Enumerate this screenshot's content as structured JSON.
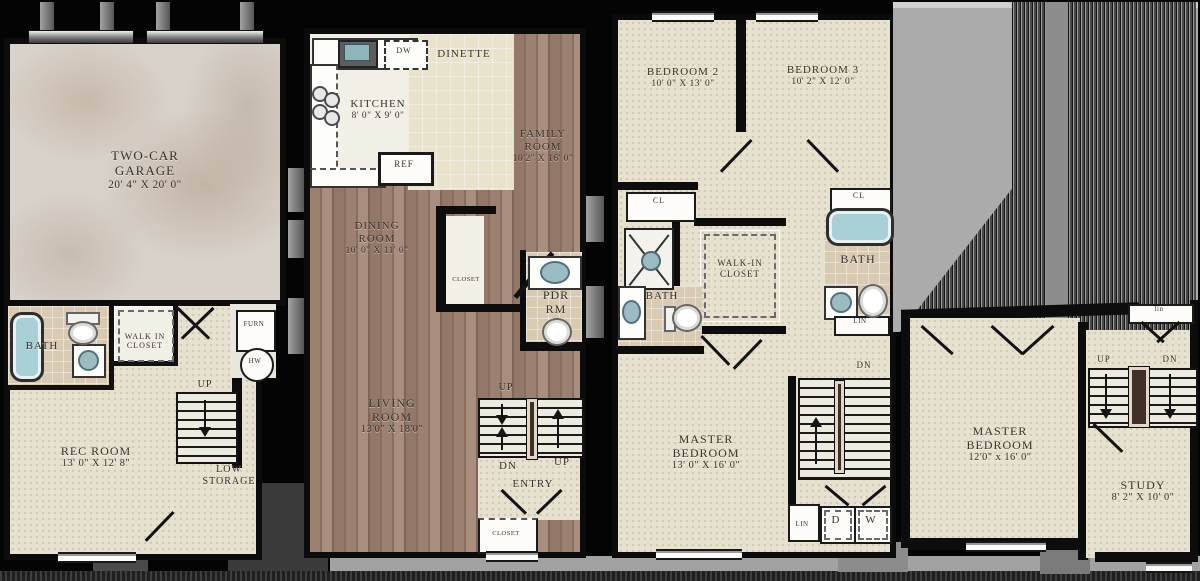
{
  "basement": {
    "garage": {
      "line1": "TWO-CAR",
      "line2": "GARAGE",
      "dims": "20' 4\" X 20' 0\""
    },
    "bath": {
      "label": "BATH"
    },
    "walk_in_closet": {
      "line1": "WALK IN",
      "line2": "CLOSET"
    },
    "rec_room": {
      "line1": "REC ROOM",
      "dims": "13' 0\" X 12' 8\""
    },
    "stairs": {
      "up": "UP"
    },
    "low_storage": {
      "line1": "LOW",
      "line2": "STORAGE"
    },
    "furnace": "FURN",
    "water_heater": "HW"
  },
  "main": {
    "kitchen": {
      "name": "KITCHEN",
      "dims": "8' 0\" X 9' 0\""
    },
    "dishwasher": "DW",
    "refrigerator": "REF",
    "dinette": "DINETTE",
    "family_room": {
      "line1": "FAMILY",
      "line2": "ROOM",
      "dims": "10'2\" X 16' 0\""
    },
    "dining_room": {
      "line1": "DINING",
      "line2": "ROOM",
      "dims": "10' 0\" X 11' 0\""
    },
    "closet": "CLOSET",
    "powder_room": {
      "line1": "PDR",
      "line2": "RM"
    },
    "living_room": {
      "line1": "LIVING",
      "line2": "ROOM",
      "dims": "13'0\" X 18'0\""
    },
    "stairs": {
      "up_top": "UP",
      "down": "DN",
      "up_right": "UP"
    },
    "entry": "ENTRY",
    "entry_closet": "CLOSET"
  },
  "second": {
    "bedroom2": {
      "name": "BEDROOM 2",
      "dims": "10' 0\" X 13' 0\""
    },
    "bedroom3": {
      "name": "BEDROOM 3",
      "dims": "10' 2\" X 12' 0\""
    },
    "closet_left": "CL",
    "closet_right": "CL",
    "walk_in_closet": {
      "line1": "WALK-IN",
      "line2": "CLOSET"
    },
    "bath_left": "BATH",
    "bath_right": "BATH",
    "linen_right": "LIN",
    "stairs": {
      "down": "DN"
    },
    "master_bedroom": {
      "line1": "MASTER",
      "line2": "BEDROOM",
      "dims": "13' 0\" X 16' 0\""
    },
    "linen_bottom": "LIN",
    "dryer": "D",
    "washer": "W"
  },
  "loft": {
    "linen": "lin",
    "stairs": {
      "up": "UP",
      "down": "DN"
    },
    "master_bedroom": {
      "line1": "MASTER",
      "line2": "BEDROOM",
      "dims": "12'0\" x 16' 0\""
    },
    "study": {
      "name": "STUDY",
      "dims": "8' 2\" X 10' 0\""
    }
  },
  "colors": {
    "wall": "#0c0c0c",
    "carpet": "#e7e1cf",
    "wood": "#977c6c",
    "concrete": "#d8d2ca",
    "tub": "#a9cfd7",
    "roof": "#ababab"
  }
}
